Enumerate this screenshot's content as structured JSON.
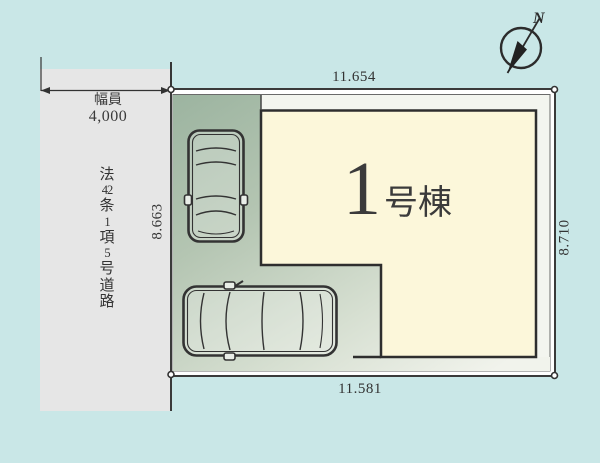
{
  "compass": {
    "north_label": "N"
  },
  "road": {
    "width_label": "幅員",
    "width_value": "4,000",
    "name_chars": [
      "法",
      "42",
      "条",
      "1",
      "項",
      "5",
      "号",
      "道",
      "路"
    ]
  },
  "plot": {
    "dimensions": {
      "top": "11.654",
      "bottom": "11.581",
      "left": "8.663",
      "right": "8.710"
    }
  },
  "building": {
    "number": "1",
    "suffix": "号棟"
  },
  "colors": {
    "background": "#c9e7e7",
    "road_fill": "#e6e6e6",
    "plot_margin_fill": "#f3f5ef",
    "parking_gradient_start": "#9cb4a0",
    "parking_gradient_end": "#f1f3ec",
    "building_fill": "#fcf7da",
    "outline": "#333333"
  }
}
